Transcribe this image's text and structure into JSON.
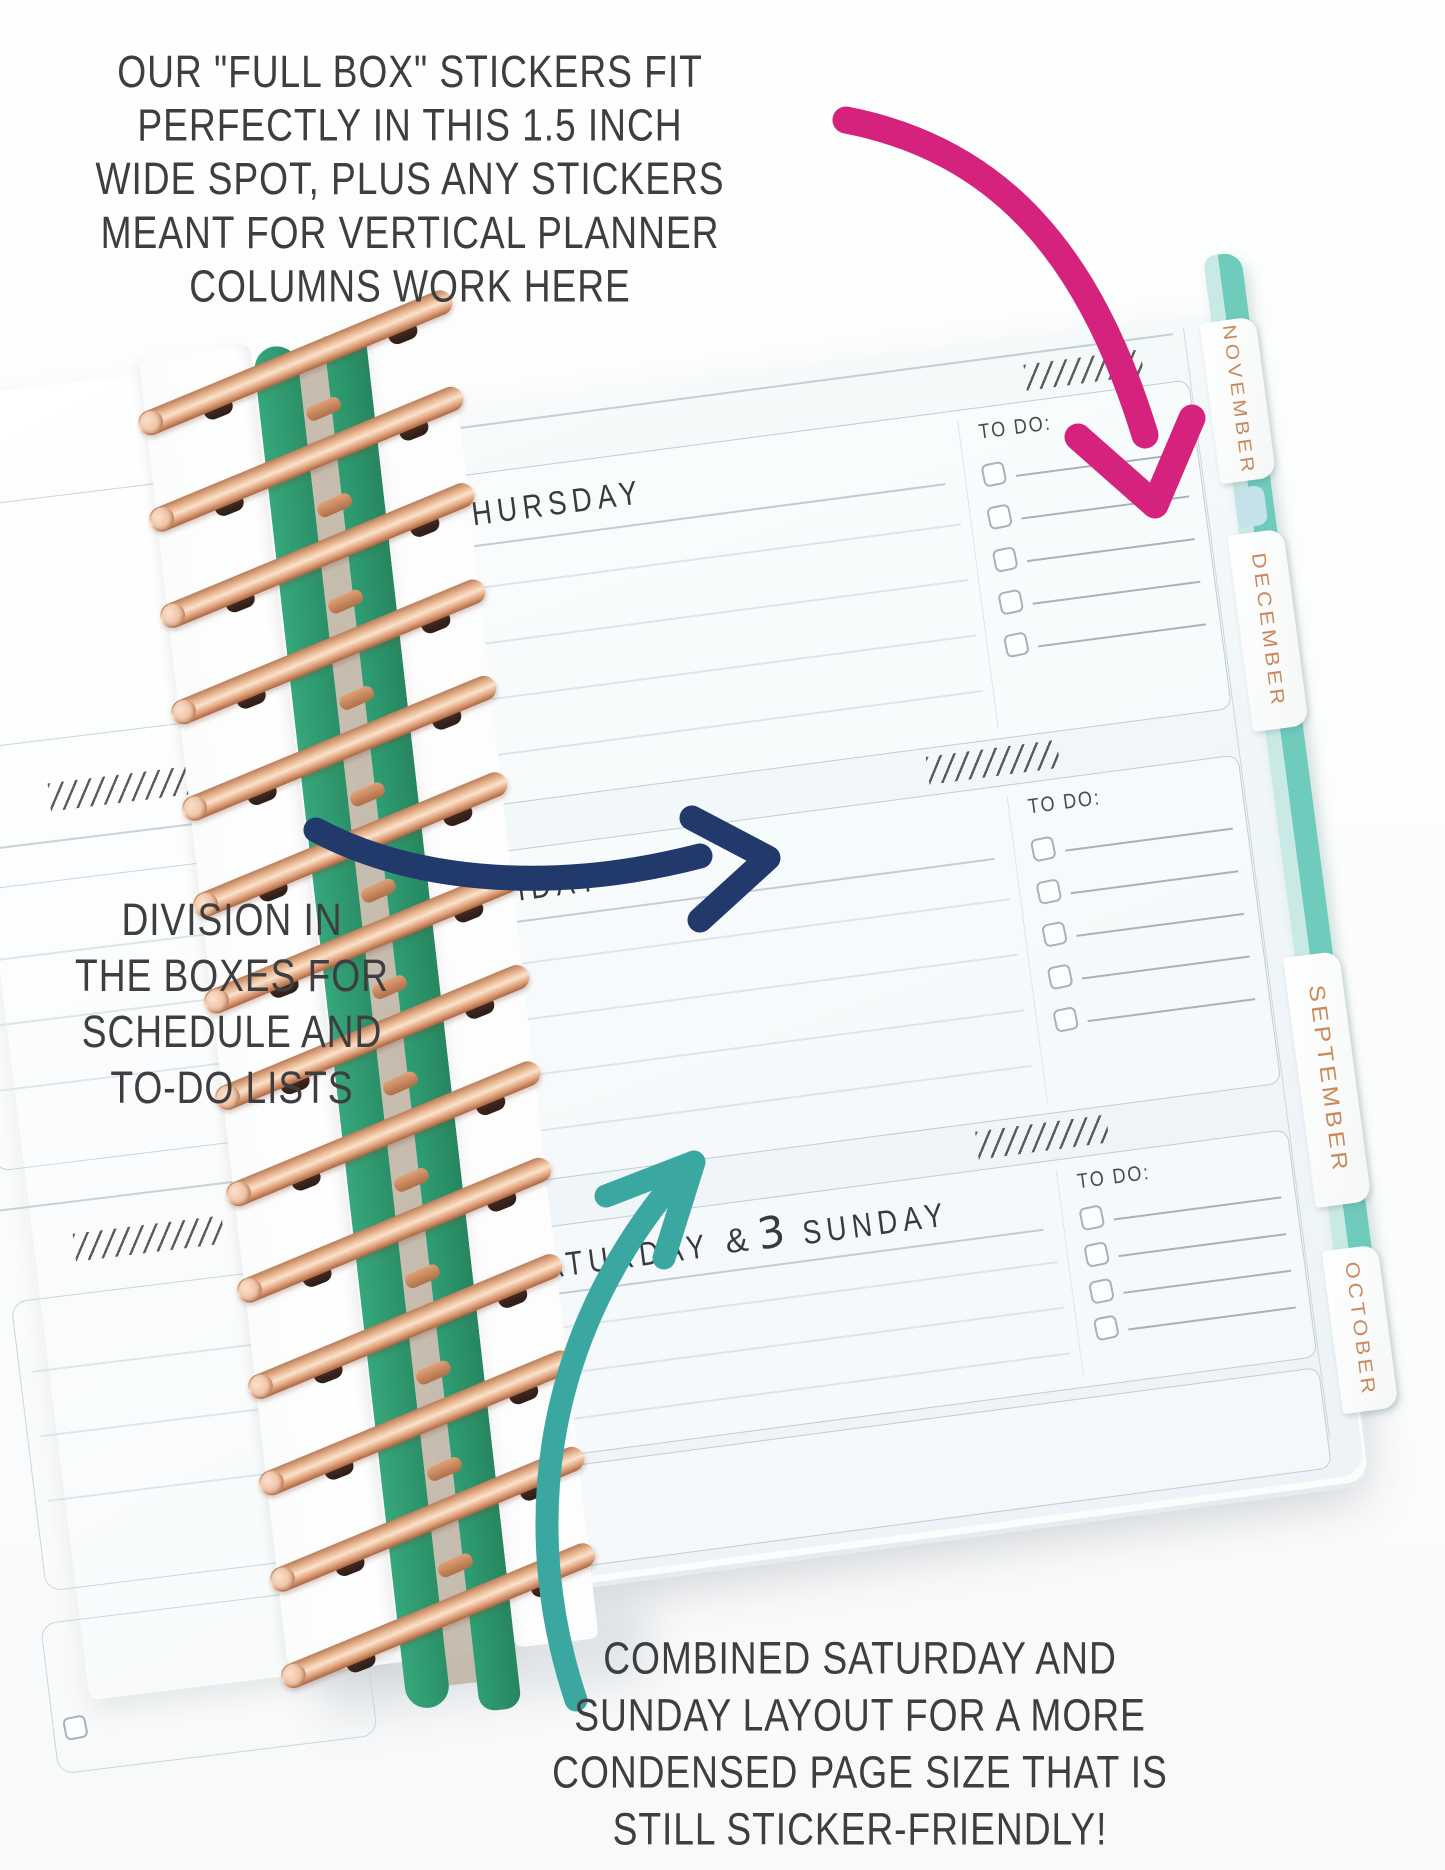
{
  "annotations": {
    "top": {
      "lines": [
        "OUR \"FULL BOX\" STICKERS FIT",
        "PERFECTLY IN THIS 1.5 INCH",
        "WIDE SPOT, PLUS ANY STICKERS",
        "MEANT FOR VERTICAL PLANNER",
        "COLUMNS WORK HERE"
      ]
    },
    "left": {
      "lines": [
        "DIVISION IN",
        "THE BOXES FOR",
        "SCHEDULE AND",
        "TO-DO LISTS"
      ]
    },
    "bottom": {
      "lines": [
        "COMBINED SATURDAY AND",
        "SUNDAY LAYOUT FOR A MORE",
        "CONDENSED PAGE SIZE THAT IS",
        "STILL STICKER-FRIENDLY!"
      ]
    }
  },
  "planner": {
    "month_tabs": [
      "NOVEMBER",
      "DECEMBER",
      "SEPTEMBER",
      "OCTOBER"
    ],
    "days": [
      {
        "date_number": "31",
        "day_name": "THURSDAY",
        "todo_label": "TO DO:"
      },
      {
        "date_number": "1",
        "day_name": "FRIDAY",
        "todo_label": "TO DO:"
      },
      {
        "date_number": "2",
        "day_name": "SATURDAY",
        "separator": "&",
        "date_number_2": "3",
        "day_name_2": "SUNDAY",
        "todo_label": "TO DO:"
      }
    ]
  },
  "colors": {
    "arrow_pink": "#d5227d",
    "arrow_navy": "#21396b",
    "arrow_teal": "#3aa8a1",
    "tab_text": "#cb8a5e",
    "cover_teal": "#6fcbbc",
    "cover_mint": "#c9e9e4",
    "coil_rose_gold": "#e8b691",
    "binding_green": "#2f9e74",
    "annotation_text": "#3e3e40"
  }
}
